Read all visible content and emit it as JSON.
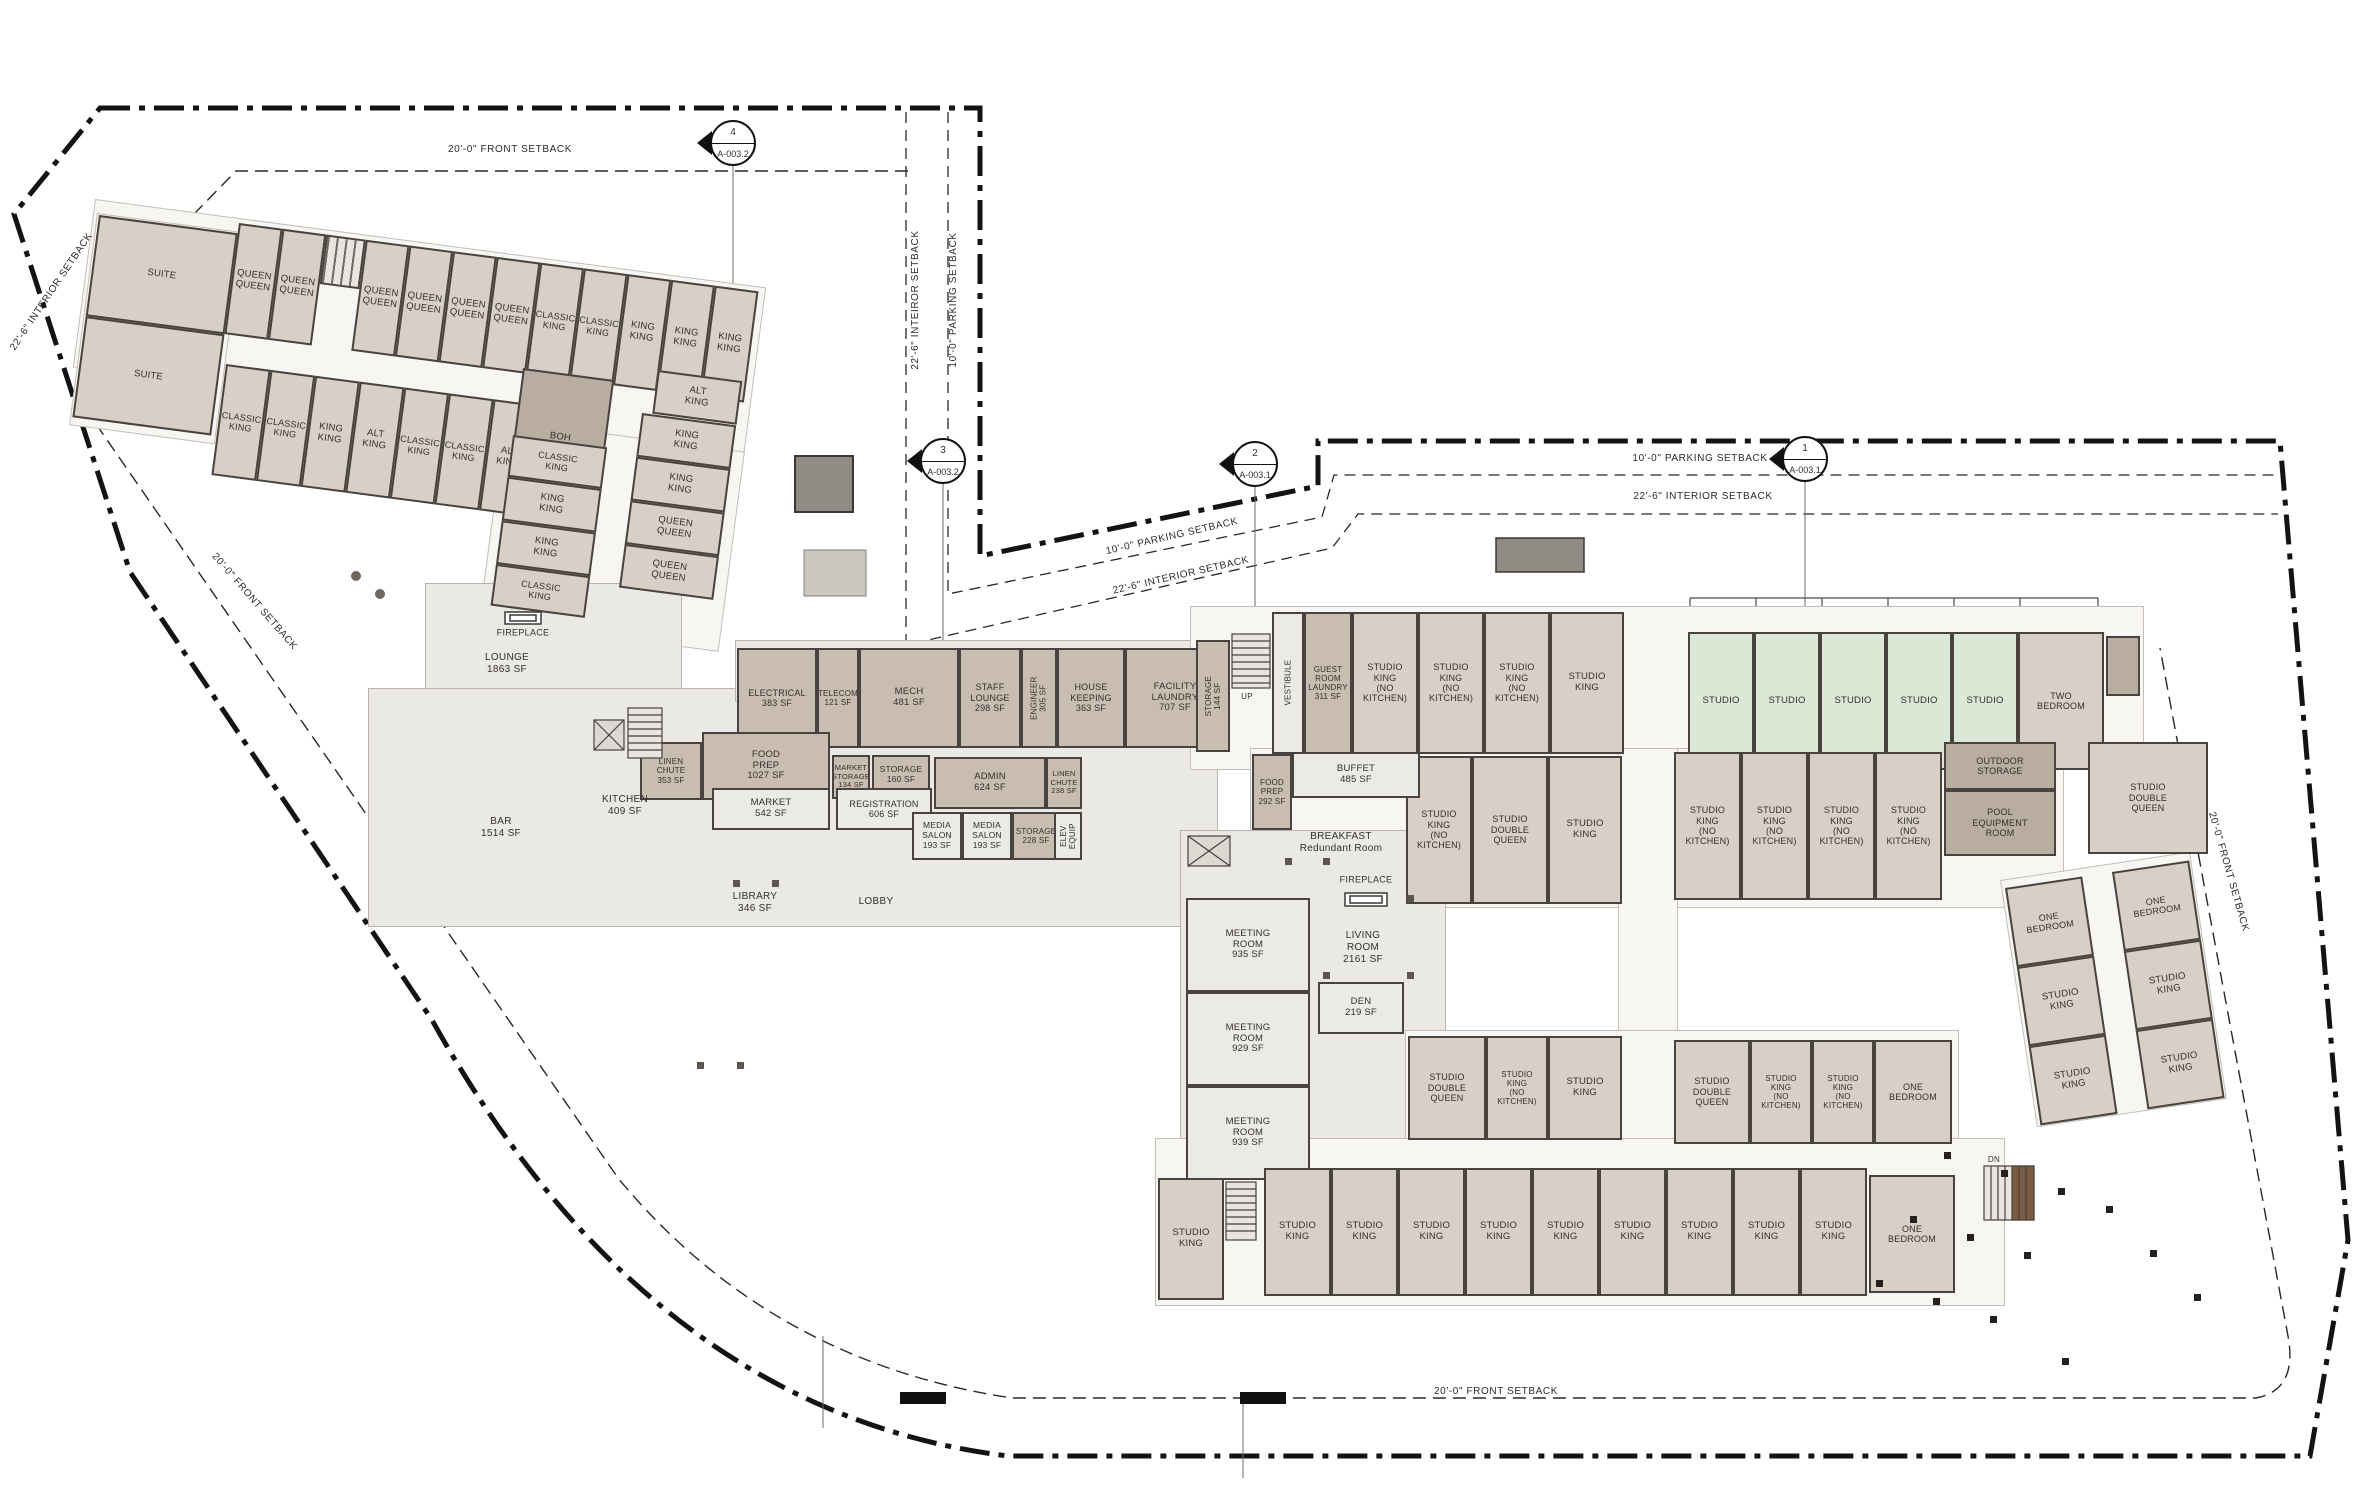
{
  "drawing": {
    "type": "architectural-floor-plan",
    "colors": {
      "guestroom_tan": "#d8cfc7",
      "service_dark": "#c9bdb2",
      "utility_darkest": "#b9aca1",
      "studio_green": "#dbe8d6",
      "public_light": "#eceae7",
      "boundary": "#141311",
      "wall": "#48433e"
    }
  },
  "setback_labels": [
    {
      "t": "20'-0\" FRONT SETBACK",
      "x": 510,
      "y": 150,
      "r": 0
    },
    {
      "t": "22'-6\" INTEIROR SETBACK",
      "x": 916,
      "y": 300,
      "r": -90
    },
    {
      "t": "10'-0\" PARKING SETBACK",
      "x": 954,
      "y": 300,
      "r": -90
    },
    {
      "t": "10'-0\" PARKING SETBACK",
      "x": 1700,
      "y": 459,
      "r": 0
    },
    {
      "t": "22'-6\" INTERIOR SETBACK",
      "x": 1703,
      "y": 497,
      "r": 0
    },
    {
      "t": "10'-0\" PARKING SETBACK",
      "x": 1172,
      "y": 537,
      "r": -13
    },
    {
      "t": "22'-6\" INTERIOR SETBACK",
      "x": 1181,
      "y": 576,
      "r": -13
    },
    {
      "t": "20'-0\" FRONT SETBACK",
      "x": 254,
      "y": 602,
      "r": 49
    },
    {
      "t": "22'-6\" INTERIOR SETBACK",
      "x": 52,
      "y": 292,
      "r": -56
    },
    {
      "t": "20'-0\" FRONT SETBACK",
      "x": 2228,
      "y": 872,
      "r": 74
    },
    {
      "t": "20'-0\" FRONT SETBACK",
      "x": 1496,
      "y": 1392,
      "r": 0
    }
  ],
  "plan_labels": [
    {
      "t": "FIREPLACE",
      "x": 523,
      "y": 633,
      "fs": 9
    },
    {
      "t": "LOUNGE\n1863 SF",
      "x": 507,
      "y": 664
    },
    {
      "t": "BAR\n1514 SF",
      "x": 501,
      "y": 828
    },
    {
      "t": "KITCHEN\n409 SF",
      "x": 625,
      "y": 806
    },
    {
      "t": "LIBRARY\n346 SF",
      "x": 755,
      "y": 903
    },
    {
      "t": "LOBBY",
      "x": 876,
      "y": 902
    },
    {
      "t": "BREAKFAST\nRedundant Room",
      "x": 1341,
      "y": 843
    },
    {
      "t": "FIREPLACE",
      "x": 1366,
      "y": 880,
      "fs": 9
    },
    {
      "t": "LIVING\nROOM\n2161 SF",
      "x": 1363,
      "y": 948
    },
    {
      "t": "UP",
      "x": 1247,
      "y": 697,
      "fs": 8
    },
    {
      "t": "DN",
      "x": 1994,
      "y": 1160,
      "fs": 8
    }
  ],
  "markers": [
    {
      "n": "4",
      "s": "A-003.2",
      "x": 733,
      "y": 143
    },
    {
      "n": "3",
      "s": "A-003.2",
      "x": 943,
      "y": 461
    },
    {
      "n": "2",
      "s": "A-003.1",
      "x": 1255,
      "y": 464
    },
    {
      "n": "1",
      "s": "A-003.1",
      "x": 1805,
      "y": 459
    }
  ],
  "slabs": [
    {
      "x": 95,
      "y": 199,
      "w": 675,
      "h": 168,
      "r": 7.5,
      "c": "wing"
    },
    {
      "x": 97,
      "y": 213,
      "w": 145,
      "h": 212,
      "r": 7.5,
      "c": "wing"
    },
    {
      "x": 505,
      "y": 420,
      "w": 240,
      "h": 200,
      "r": 7.5,
      "c": "wing"
    },
    {
      "x": 425,
      "y": 583,
      "w": 255,
      "h": 205,
      "r": 0,
      "c": "pub"
    },
    {
      "x": 368,
      "y": 688,
      "w": 848,
      "h": 237,
      "r": 0,
      "c": "pub"
    },
    {
      "x": 735,
      "y": 640,
      "w": 520,
      "h": 60,
      "r": 0,
      "c": "pub"
    },
    {
      "x": 1190,
      "y": 606,
      "w": 952,
      "h": 162,
      "r": 0,
      "c": "wing"
    },
    {
      "x": 1250,
      "y": 748,
      "w": 812,
      "h": 158,
      "r": 0,
      "c": "wing"
    },
    {
      "x": 1618,
      "y": 748,
      "w": 58,
      "h": 424,
      "r": 0,
      "c": "wing"
    },
    {
      "x": 1180,
      "y": 830,
      "w": 264,
      "h": 362,
      "r": 0,
      "c": "pub"
    },
    {
      "x": 1405,
      "y": 1030,
      "w": 552,
      "h": 120,
      "r": 0,
      "c": "wing"
    },
    {
      "x": 1155,
      "y": 1138,
      "w": 848,
      "h": 166,
      "r": 0,
      "c": "wing"
    },
    {
      "x": 2000,
      "y": 880,
      "w": 190,
      "h": 248,
      "r": -8.5,
      "c": "wing"
    }
  ],
  "room_groups": [
    {
      "nm": "wing-a-suites",
      "x": 99,
      "y": 215,
      "r": 7.5,
      "d": "column",
      "w": 140,
      "items": [
        {
          "t": "SUITE",
          "h": 102
        },
        {
          "t": "SUITE",
          "h": 102
        }
      ]
    },
    {
      "nm": "wing-a-top-bar",
      "x": 239,
      "y": 223,
      "r": 7.5,
      "h": 112,
      "items": [
        {
          "t": "QUEEN\nQUEEN",
          "w": 44
        },
        {
          "t": "QUEEN\nQUEEN",
          "w": 44
        },
        {
          "t": "",
          "w": 40,
          "h": 50,
          "v": "s"
        },
        {
          "t": "QUEEN\nQUEEN",
          "w": 44
        },
        {
          "t": "QUEEN\nQUEEN",
          "w": 44
        },
        {
          "t": "QUEEN\nQUEEN",
          "w": 44
        },
        {
          "t": "QUEEN\nQUEEN",
          "w": 44
        },
        {
          "t": "CLASSIC\nKING",
          "w": 44,
          "fs": 9
        },
        {
          "t": "CLASSIC\nKING",
          "w": 44,
          "fs": 9
        },
        {
          "t": "KING\nKING",
          "w": 44
        },
        {
          "t": "KING\nKING",
          "w": 44
        },
        {
          "t": "KING\nKING",
          "w": 44
        }
      ]
    },
    {
      "nm": "wing-a-bottom-bar",
      "x": 226,
      "y": 364,
      "r": 7.5,
      "h": 112,
      "items": [
        {
          "t": "CLASSIC\nKING",
          "w": 45,
          "fs": 9
        },
        {
          "t": "CLASSIC\nKING",
          "w": 45,
          "fs": 9
        },
        {
          "t": "KING\nKING",
          "w": 45
        },
        {
          "t": "ALT\nKING",
          "w": 45
        },
        {
          "t": "CLASSIC\nKING",
          "w": 45,
          "fs": 9
        },
        {
          "t": "CLASSIC\nKING",
          "w": 45,
          "fs": 9
        },
        {
          "t": "ALT\nKING",
          "w": 45
        }
      ]
    },
    {
      "nm": "wing-a-boh",
      "x": 523,
      "y": 368,
      "r": 7.5,
      "items": [
        {
          "t": "BOH",
          "w": 92,
          "h": 128,
          "v": "k"
        }
      ]
    },
    {
      "nm": "wing-a-alt-king",
      "x": 658,
      "y": 370,
      "r": 7.5,
      "items": [
        {
          "t": "ALT\nKING",
          "w": 85,
          "h": 44
        }
      ]
    },
    {
      "nm": "wing-a-column-1",
      "x": 513,
      "y": 435,
      "r": 7.5,
      "d": "column",
      "w": 95,
      "items": [
        {
          "t": "CLASSIC\nKING",
          "h": 42,
          "fs": 9
        },
        {
          "t": "KING\nKING",
          "h": 44
        },
        {
          "t": "KING\nKING",
          "h": 44
        },
        {
          "t": "CLASSIC\nKING",
          "h": 42,
          "fs": 9
        }
      ]
    },
    {
      "nm": "wing-a-column-2",
      "x": 642,
      "y": 413,
      "r": 7.5,
      "d": "column",
      "w": 95,
      "items": [
        {
          "t": "KING\nKING",
          "h": 44
        },
        {
          "t": "KING\nKING",
          "h": 44
        },
        {
          "t": "QUEEN\nQUEEN",
          "h": 44
        },
        {
          "t": "QUEEN\nQUEEN",
          "h": 44
        }
      ]
    },
    {
      "nm": "service-row",
      "x": 737,
      "y": 648,
      "h": 100,
      "items": [
        {
          "t": "ELECTRICAL\n383 SF",
          "w": 80,
          "v": "d",
          "fs": 9
        },
        {
          "t": "TELECOM\n121 SF",
          "w": 42,
          "v": "d",
          "fs": 8
        },
        {
          "t": "MECH\n481 SF",
          "w": 100,
          "v": "d"
        },
        {
          "t": "STAFF\nLOUNGE\n298 SF",
          "w": 62,
          "v": "d",
          "fs": 9
        },
        {
          "t": "ENGINEER\n305 SF",
          "w": 36,
          "v": "d",
          "rl": 1,
          "fs": 8
        },
        {
          "t": "HOUSE\nKEEPING\n363 SF",
          "w": 68,
          "v": "d",
          "fs": 9
        },
        {
          "t": "FACILITY\nLAUNDRY\n707 SF",
          "w": 100,
          "v": "d"
        }
      ]
    },
    {
      "nm": "storage-144",
      "x": 1196,
      "y": 640,
      "items": [
        {
          "t": "STORAGE\n144 SF",
          "w": 34,
          "h": 112,
          "v": "d",
          "rl": 1,
          "fs": 8
        }
      ]
    },
    {
      "nm": "linen-chute-353",
      "x": 640,
      "y": 742,
      "items": [
        {
          "t": "LINEN\nCHUTE\n353 SF",
          "w": 62,
          "h": 58,
          "v": "d",
          "fs": 8
        }
      ]
    },
    {
      "nm": "food-prep-1027",
      "x": 702,
      "y": 732,
      "items": [
        {
          "t": "FOOD\nPREP\n1027 SF",
          "w": 128,
          "h": 68,
          "v": "d"
        }
      ]
    },
    {
      "nm": "market",
      "x": 712,
      "y": 788,
      "items": [
        {
          "t": "MARKET\n542 SF",
          "w": 118,
          "h": 42,
          "v": "l"
        }
      ]
    },
    {
      "nm": "market-storage",
      "x": 832,
      "y": 755,
      "items": [
        {
          "t": "MARKET\nSTORAGE\n134 SF",
          "w": 38,
          "h": 44,
          "v": "d",
          "fs": 7.5
        }
      ]
    },
    {
      "nm": "storage-160",
      "x": 872,
      "y": 755,
      "items": [
        {
          "t": "STORAGE\n160 SF",
          "w": 58,
          "h": 40,
          "v": "d",
          "fs": 8.5
        }
      ]
    },
    {
      "nm": "registration",
      "x": 836,
      "y": 788,
      "items": [
        {
          "t": "REGISTRATION\n606 SF",
          "w": 96,
          "h": 42,
          "v": "l",
          "fs": 9
        }
      ]
    },
    {
      "nm": "admin",
      "x": 934,
      "y": 757,
      "items": [
        {
          "t": "ADMIN\n624 SF",
          "w": 112,
          "h": 52,
          "v": "d"
        }
      ]
    },
    {
      "nm": "media-salon-1",
      "x": 912,
      "y": 812,
      "items": [
        {
          "t": "MEDIA\nSALON\n193 SF",
          "w": 50,
          "h": 48,
          "v": "l",
          "fs": 8.5
        }
      ]
    },
    {
      "nm": "media-salon-2",
      "x": 962,
      "y": 812,
      "items": [
        {
          "t": "MEDIA\nSALON\n193 SF",
          "w": 50,
          "h": 48,
          "v": "l",
          "fs": 8.5
        }
      ]
    },
    {
      "nm": "storage-228",
      "x": 1012,
      "y": 812,
      "items": [
        {
          "t": "STORAGE\n228 SF",
          "w": 48,
          "h": 48,
          "v": "d",
          "fs": 8
        }
      ]
    },
    {
      "nm": "linen-chute-238",
      "x": 1046,
      "y": 757,
      "items": [
        {
          "t": "LINEN\nCHUTE\n238 SF",
          "w": 36,
          "h": 52,
          "v": "d",
          "fs": 7.5
        }
      ]
    },
    {
      "nm": "elev-equip",
      "x": 1054,
      "y": 812,
      "items": [
        {
          "t": "ELEV\nEQUIP",
          "w": 28,
          "h": 48,
          "v": "l",
          "rl": 1,
          "fs": 8
        }
      ]
    },
    {
      "nm": "wing-b-row",
      "x": 1272,
      "y": 612,
      "h": 142,
      "items": [
        {
          "t": "VESTIBULE",
          "w": 32,
          "v": "l",
          "rl": 1,
          "fs": 8
        },
        {
          "t": "GUEST\nROOM\nLAUNDRY\n311 SF",
          "w": 48,
          "v": "d",
          "fs": 8
        },
        {
          "t": "STUDIO\nKING\n(NO\nKITCHEN)",
          "w": 66,
          "fs": 9
        },
        {
          "t": "STUDIO\nKING\n(NO\nKITCHEN)",
          "w": 66,
          "fs": 9
        },
        {
          "t": "STUDIO\nKING\n(NO\nKITCHEN)",
          "w": 66,
          "fs": 9
        },
        {
          "t": "STUDIO\nKING",
          "w": 74
        }
      ]
    },
    {
      "nm": "studio-green-row",
      "x": 1688,
      "y": 632,
      "h": 138,
      "items": [
        {
          "t": "STUDIO",
          "w": 66,
          "v": "g"
        },
        {
          "t": "STUDIO",
          "w": 66,
          "v": "g"
        },
        {
          "t": "STUDIO",
          "w": 66,
          "v": "g"
        },
        {
          "t": "STUDIO",
          "w": 66,
          "v": "g"
        },
        {
          "t": "STUDIO",
          "w": 66,
          "v": "g"
        },
        {
          "t": "TWO\nBEDROOM",
          "w": 86,
          "fs": 9
        }
      ]
    },
    {
      "nm": "green-row-elevator",
      "x": 2106,
      "y": 636,
      "items": [
        {
          "t": "",
          "w": 34,
          "h": 60,
          "v": "k"
        }
      ]
    },
    {
      "nm": "wing-c-row-left",
      "x": 1406,
      "y": 756,
      "h": 148,
      "items": [
        {
          "t": "STUDIO\nKING\n(NO\nKITCHEN)",
          "w": 66,
          "fs": 9
        },
        {
          "t": "STUDIO\nDOUBLE\nQUEEN",
          "w": 76,
          "fs": 9
        },
        {
          "t": "STUDIO\nKING",
          "w": 74
        }
      ]
    },
    {
      "nm": "wing-c-row-right",
      "x": 1674,
      "y": 752,
      "h": 148,
      "items": [
        {
          "t": "STUDIO\nKING\n(NO\nKITCHEN)",
          "w": 67,
          "fs": 9
        },
        {
          "t": "STUDIO\nKING\n(NO\nKITCHEN)",
          "w": 67,
          "fs": 9
        },
        {
          "t": "STUDIO\nKING\n(NO\nKITCHEN)",
          "w": 67,
          "fs": 9
        },
        {
          "t": "STUDIO\nKING\n(NO\nKITCHEN)",
          "w": 67,
          "fs": 9
        }
      ]
    },
    {
      "nm": "utility-column",
      "x": 1944,
      "y": 742,
      "d": "column",
      "w": 112,
      "items": [
        {
          "t": "OUTDOOR\nSTORAGE",
          "h": 48,
          "v": "k",
          "fs": 9
        },
        {
          "t": "POOL\nEQUIPMENT\nROOM",
          "h": 66,
          "v": "k",
          "fs": 9
        }
      ]
    },
    {
      "nm": "studio-double-queen-detached",
      "x": 2088,
      "y": 742,
      "items": [
        {
          "t": "STUDIO\nDOUBLE\nQUEEN",
          "w": 120,
          "h": 112,
          "fs": 9
        }
      ]
    },
    {
      "nm": "buffet",
      "x": 1292,
      "y": 752,
      "items": [
        {
          "t": "BUFFET\n485 SF",
          "w": 128,
          "h": 46,
          "v": "l"
        }
      ]
    },
    {
      "nm": "food-prep-292",
      "x": 1252,
      "y": 754,
      "items": [
        {
          "t": "FOOD\nPREP\n292 SF",
          "w": 40,
          "h": 76,
          "v": "d",
          "fs": 8
        }
      ]
    },
    {
      "nm": "meeting-column",
      "x": 1186,
      "y": 898,
      "d": "column",
      "w": 124,
      "items": [
        {
          "t": "MEETING\nROOM\n935 SF",
          "h": 94,
          "v": "l"
        },
        {
          "t": "MEETING\nROOM\n929 SF",
          "h": 94,
          "v": "l"
        },
        {
          "t": "MEETING\nROOM\n939 SF",
          "h": 94,
          "v": "l"
        }
      ]
    },
    {
      "nm": "den",
      "x": 1318,
      "y": 982,
      "items": [
        {
          "t": "DEN\n219 SF",
          "w": 86,
          "h": 52,
          "v": "l"
        }
      ]
    },
    {
      "nm": "bottom-upper-left",
      "x": 1408,
      "y": 1036,
      "h": 104,
      "items": [
        {
          "t": "STUDIO\nDOUBLE\nQUEEN",
          "w": 78,
          "fs": 9
        },
        {
          "t": "STUDIO\nKING\n(NO\nKITCHEN)",
          "w": 62,
          "fs": 8
        },
        {
          "t": "STUDIO\nKING",
          "w": 74
        }
      ]
    },
    {
      "nm": "bottom-upper-right",
      "x": 1674,
      "y": 1040,
      "h": 104,
      "items": [
        {
          "t": "STUDIO\nDOUBLE\nQUEEN",
          "w": 76,
          "fs": 9
        },
        {
          "t": "STUDIO\nKING\n(NO\nKITCHEN)",
          "w": 62,
          "fs": 8
        },
        {
          "t": "STUDIO\nKING\n(NO\nKITCHEN)",
          "w": 62,
          "fs": 8
        },
        {
          "t": "ONE\nBEDROOM",
          "w": 78,
          "fs": 9
        }
      ]
    },
    {
      "nm": "bottom-lower-first",
      "x": 1158,
      "y": 1178,
      "items": [
        {
          "t": "STUDIO\nKING",
          "w": 66,
          "h": 122
        }
      ]
    },
    {
      "nm": "bottom-lower-row",
      "x": 1264,
      "y": 1168,
      "h": 128,
      "items": [
        {
          "t": "STUDIO\nKING",
          "w": 67
        },
        {
          "t": "STUDIO\nKING",
          "w": 67
        },
        {
          "t": "STUDIO\nKING",
          "w": 67
        },
        {
          "t": "STUDIO\nKING",
          "w": 67
        },
        {
          "t": "STUDIO\nKING",
          "w": 67
        },
        {
          "t": "STUDIO\nKING",
          "w": 67
        },
        {
          "t": "STUDIO\nKING",
          "w": 67
        },
        {
          "t": "STUDIO\nKING",
          "w": 67
        },
        {
          "t": "STUDIO\nKING",
          "w": 67
        }
      ]
    },
    {
      "nm": "one-bedroom-bottom",
      "x": 1869,
      "y": 1175,
      "items": [
        {
          "t": "ONE\nBEDROOM",
          "w": 86,
          "h": 118,
          "fs": 9
        }
      ]
    },
    {
      "nm": "detached-col-1",
      "x": 2005,
      "y": 888,
      "r": -8.5,
      "d": "column",
      "w": 78,
      "items": [
        {
          "t": "ONE\nBEDROOM",
          "h": 80,
          "fs": 9
        },
        {
          "t": "STUDIO\nKING",
          "h": 80
        },
        {
          "t": "STUDIO\nKING",
          "h": 80
        }
      ]
    },
    {
      "nm": "detached-col-2",
      "x": 2112,
      "y": 872,
      "r": -8.5,
      "d": "column",
      "w": 78,
      "items": [
        {
          "t": "ONE\nBEDROOM",
          "h": 80,
          "fs": 9
        },
        {
          "t": "STUDIO\nKING",
          "h": 80
        },
        {
          "t": "STUDIO\nKING",
          "h": 80
        }
      ]
    }
  ]
}
